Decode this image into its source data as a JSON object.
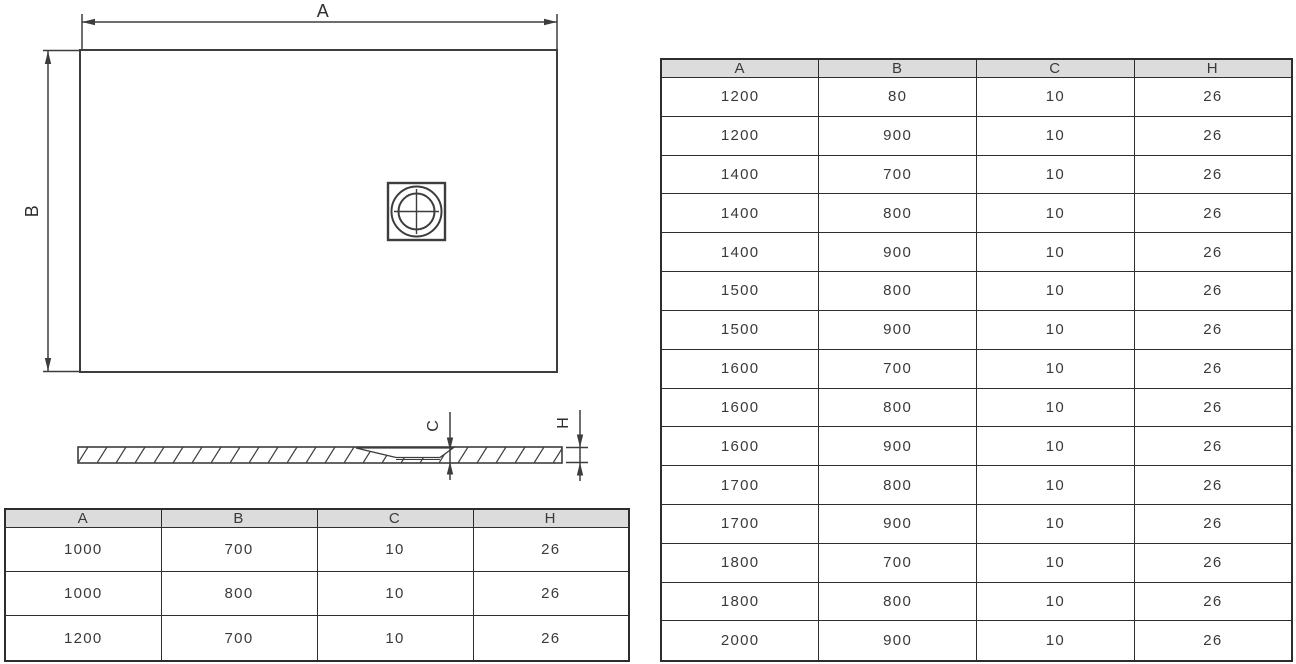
{
  "diagram": {
    "labels": {
      "a": "A",
      "b": "B",
      "c": "C",
      "h": "H"
    },
    "icons": {
      "drain": "drain-crosshair-symbol"
    },
    "views": {
      "plan": "shower-tray-top-view",
      "profile": "shower-tray-side-section"
    }
  },
  "tables": {
    "left": {
      "headers": [
        "A",
        "B",
        "C",
        "H"
      ],
      "rows": [
        [
          "1000",
          "700",
          "10",
          "26"
        ],
        [
          "1000",
          "800",
          "10",
          "26"
        ],
        [
          "1200",
          "700",
          "10",
          "26"
        ]
      ]
    },
    "right": {
      "headers": [
        "A",
        "B",
        "C",
        "H"
      ],
      "rows": [
        [
          "1200",
          "80",
          "10",
          "26"
        ],
        [
          "1200",
          "900",
          "10",
          "26"
        ],
        [
          "1400",
          "700",
          "10",
          "26"
        ],
        [
          "1400",
          "800",
          "10",
          "26"
        ],
        [
          "1400",
          "900",
          "10",
          "26"
        ],
        [
          "1500",
          "800",
          "10",
          "26"
        ],
        [
          "1500",
          "900",
          "10",
          "26"
        ],
        [
          "1600",
          "700",
          "10",
          "26"
        ],
        [
          "1600",
          "800",
          "10",
          "26"
        ],
        [
          "1600",
          "900",
          "10",
          "26"
        ],
        [
          "1700",
          "800",
          "10",
          "26"
        ],
        [
          "1700",
          "900",
          "10",
          "26"
        ],
        [
          "1800",
          "700",
          "10",
          "26"
        ],
        [
          "1800",
          "800",
          "10",
          "26"
        ],
        [
          "2000",
          "900",
          "10",
          "26"
        ]
      ]
    }
  },
  "colors": {
    "background": "#ffffff",
    "line": "#3d3d3d",
    "table_border": "#2d2d2d",
    "header_bg": "#dcdcdc",
    "text": "#3a3a3a"
  }
}
